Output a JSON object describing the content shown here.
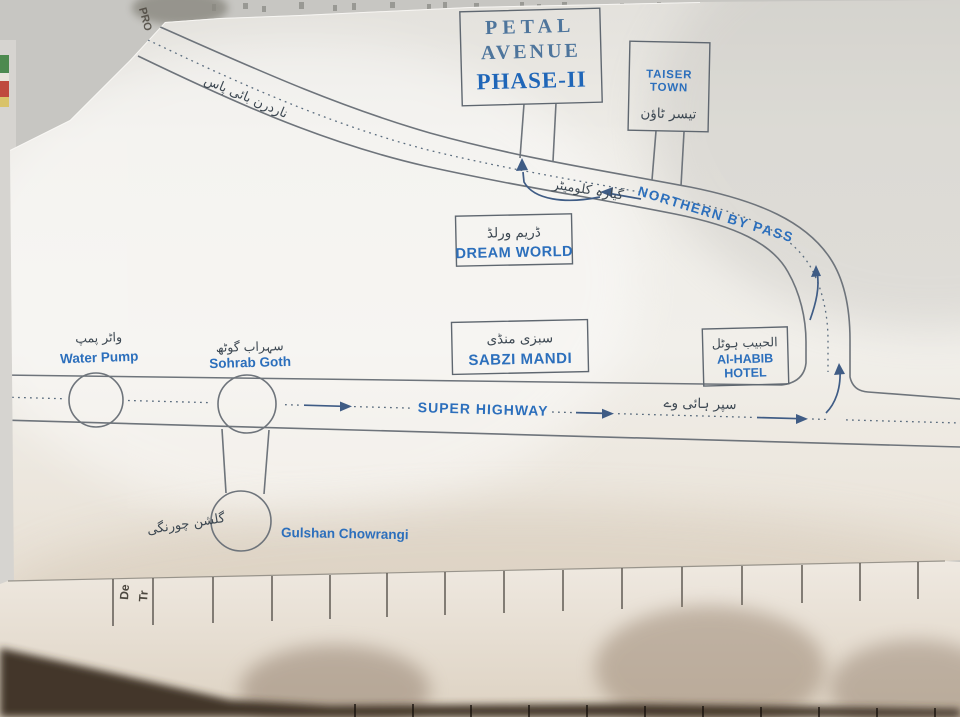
{
  "map": {
    "petal_avenue": {
      "line1": "PETAL",
      "line2": "AVENUE",
      "line3": "PHASE-II"
    },
    "taiser_town": {
      "line1": "TAISER",
      "line2": "TOWN",
      "urdu": "تیسر ٹاؤن"
    },
    "northern_bypass": {
      "label": "NORTHERN BY PASS",
      "urdu": "ناردرن بائی پاس",
      "distance_urdu": "گیارہ کلومیٹر"
    },
    "dream_world": {
      "label": "DREAM WORLD",
      "urdu": "ڈریم ورلڈ"
    },
    "sabzi_mandi": {
      "label": "SABZI MANDI",
      "urdu": "سبزی منڈی"
    },
    "al_habib_hotel": {
      "line1": "Al-HABIB",
      "line2": "HOTEL",
      "urdu": "الحبیب ہوٹل"
    },
    "water_pump": {
      "label": "Water Pump",
      "urdu": "واٹر پمپ"
    },
    "sohrab_goth": {
      "label": "Sohrab Goth",
      "urdu": "سہراب گوٹھ"
    },
    "super_highway": {
      "label": "SUPER HIGHWAY",
      "urdu": "سپر ہائی وے"
    },
    "gulshan_chowrangi": {
      "label": "Gulshan Chowrangi",
      "urdu": "گلشن چورنگی"
    }
  },
  "background_paper": {
    "fragment_top_left": "PRO",
    "form_fragment_col1": "De",
    "form_fragment_col2": "Tr"
  },
  "colors": {
    "ink_blue": "#2c6fbc",
    "title_blue": "#1f66b8",
    "road_gray": "#6e747b",
    "urdu_ink": "#3d4852",
    "arrow_blue": "#3f5c85",
    "paper": "#f0eee9"
  }
}
